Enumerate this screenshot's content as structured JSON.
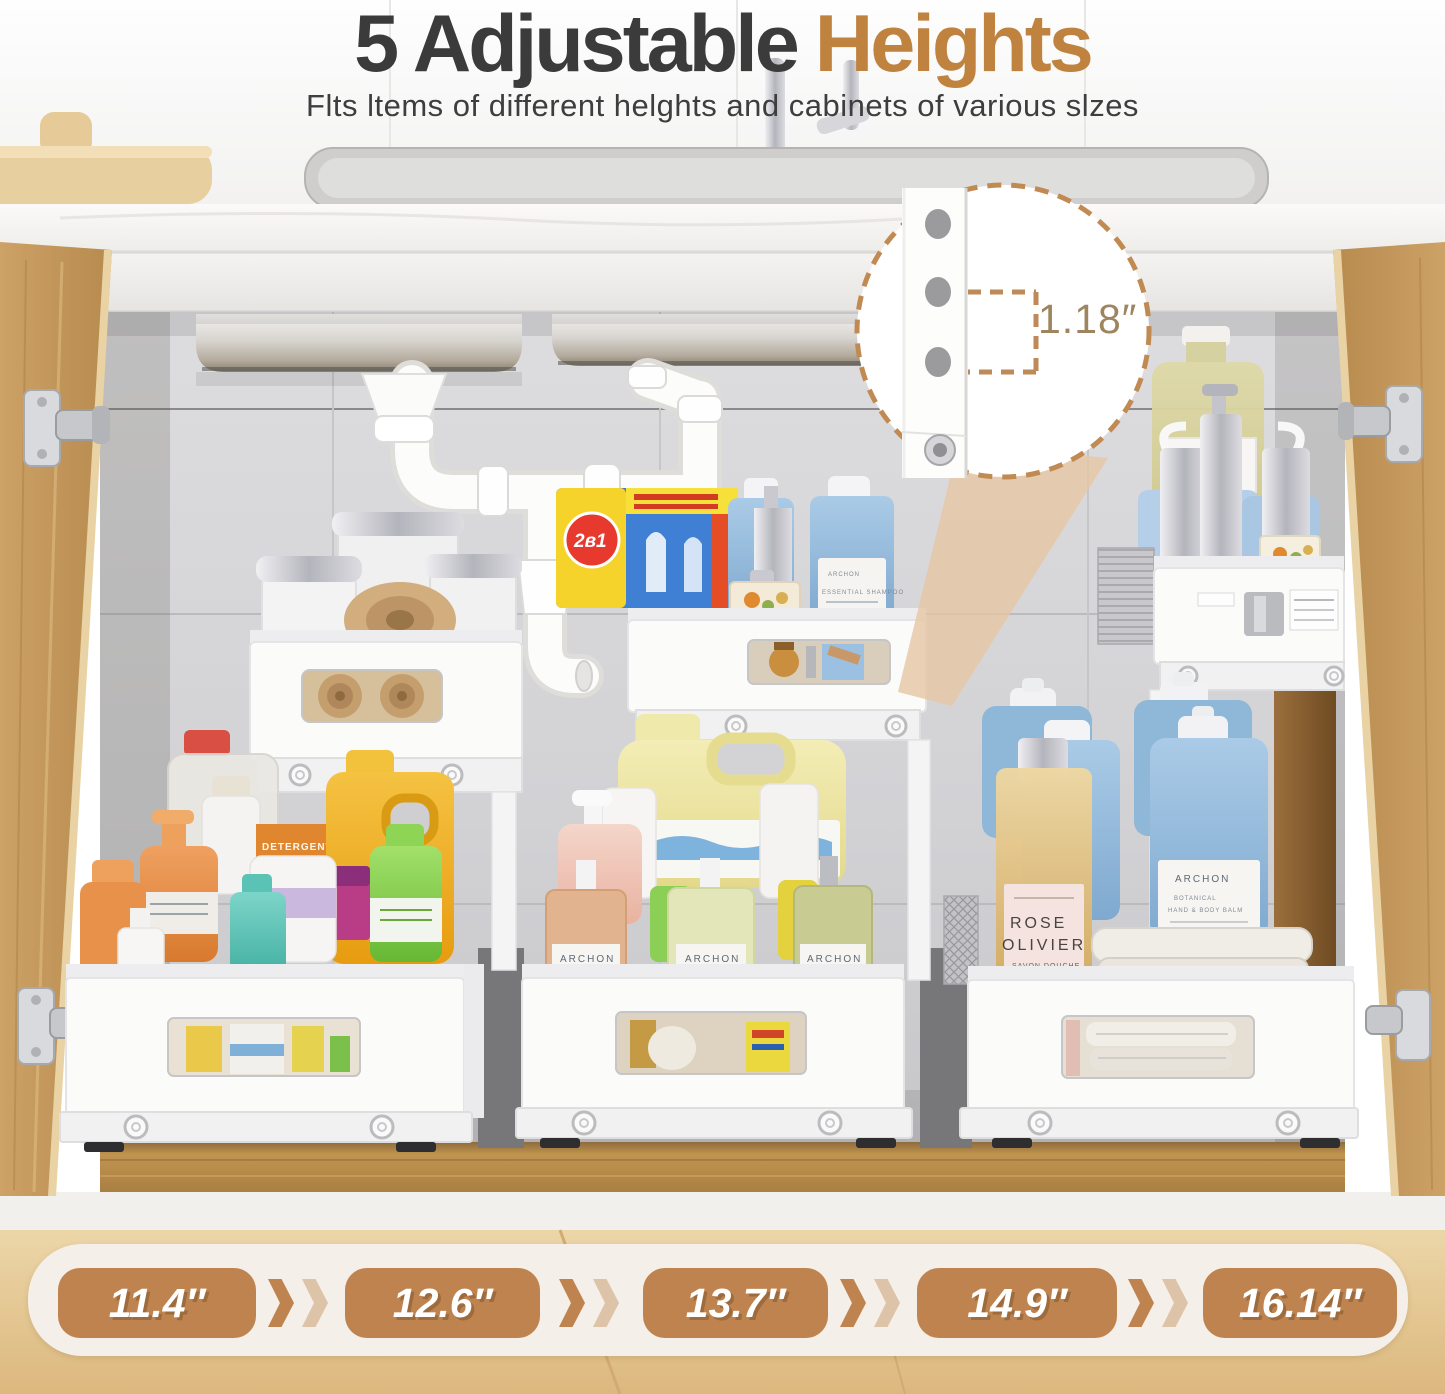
{
  "header": {
    "title_prefix": "5 Adjustable",
    "title_accent": "Heights",
    "subtitle": "Flts ltems of different helghts and cabinets of various slzes"
  },
  "callout": {
    "value": "1.18″"
  },
  "heights_bar": {
    "items": [
      "11.4″",
      "12.6″",
      "13.7″",
      "14.9″",
      "16.14″"
    ]
  },
  "products": {
    "detergent_box_badge": "2в1",
    "archon_brand": "ARCHON",
    "shampoo_line": "ESSENTIAL SHAMPOO",
    "balm_line1": "BOTANICAL",
    "balm_line2": "HAND & BODY BALM",
    "rose_line1": "ROSE",
    "rose_line2": "OLIVIER",
    "rose_line3": "SAVON DOUCHE",
    "detergent_box_text": "DETERGENT"
  },
  "colors": {
    "accent": "#c0823f",
    "badge": "#bf8350",
    "title": "#3b3b3b",
    "callout_stroke": "#c08a52"
  }
}
